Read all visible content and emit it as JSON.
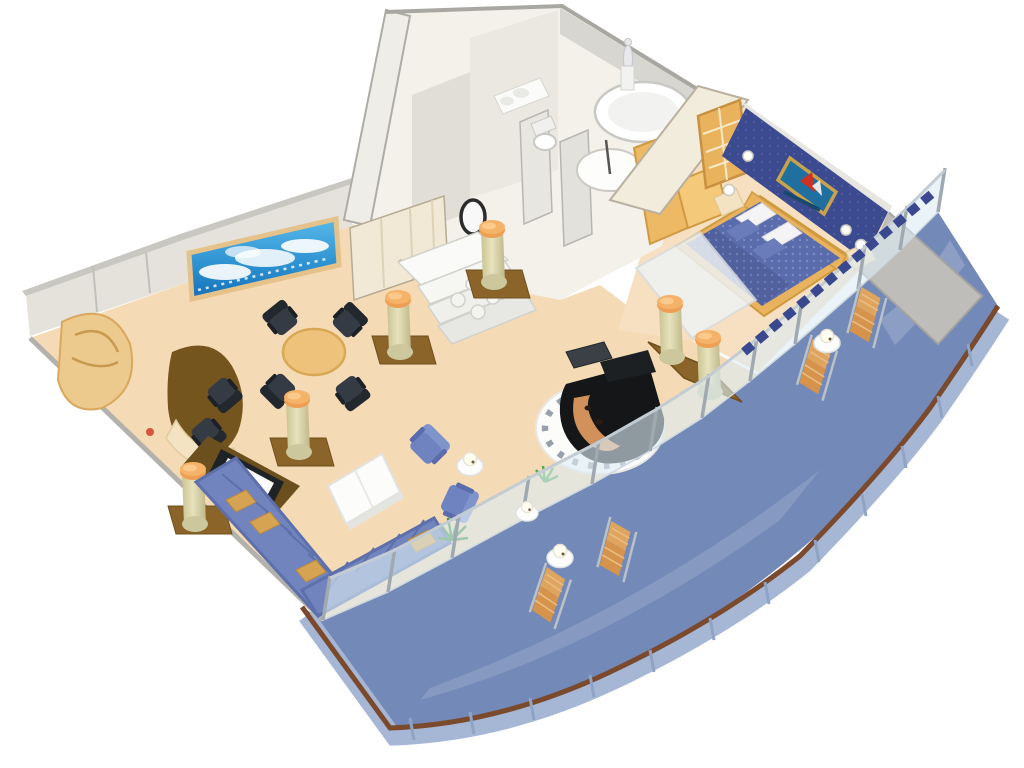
{
  "scene": {
    "type": "isometric-3d-floorplan-cutaway",
    "subject": "cruise-ship-owners-suite",
    "background": "#ffffff"
  },
  "palette": {
    "carpet": "#f5dab6",
    "carpet_light": "#f6e0c1",
    "deck_blue": "#7389b7",
    "deck_edge_band": "#a5b7d4",
    "handrail_brown": "#7b4a2d",
    "glass": "#dcebf3",
    "glass_post": "#9fa9af",
    "wall_light": "#eceae3",
    "wall_mid": "#dddbd3",
    "wall_cream": "#f1e9d6",
    "wall_top_edge": "#a9a7a1",
    "bedroom_wall_navy": "#3c4a90",
    "wood_light": "#f0c070",
    "wood_mid": "#e9b35d",
    "wood_dark": "#c89040",
    "desk_brown": "#74551d",
    "plinth_brown": "#8a6428",
    "column_body": "#ded9ae",
    "column_cap_orange": "#f2a858",
    "sofa_blue": "#7284bd",
    "sofa_shade": "#5d70ab",
    "cushion_tan": "#d6a353",
    "bed_blue": "#5b6cac",
    "pillow_white": "#f4f4f6",
    "pillow_blue": "#6b7cba",
    "chair_black": "#2d333a",
    "armchair_blue": "#6f83c0",
    "lounge_tan": "#dca05c",
    "piano_black": "#141618",
    "piano_soundboard": "#d2915a",
    "platform_white": "#fcfcfb",
    "platform_ring": "#98a0aa",
    "tv_black": "#1f2327",
    "tv_screen": "#fdfdfd",
    "plant_green": "#3f8f3d",
    "sky_top": "#57b8e8",
    "sky_deep": "#1470b8",
    "painting_sea": "#1f6f9f",
    "painting_sail_red": "#cc3322",
    "statue_white": "#e9e9ec",
    "tub_white": "#ffffff"
  },
  "rooms": {
    "living_room": {
      "name": "living-room",
      "furniture": [
        "sectional-sofa",
        "coffee-table",
        "armchair",
        "armchair",
        "side-table-lamp",
        "dining-table",
        "dining-chair-x4",
        "curved-desk",
        "desk-chair-x2",
        "corner-bar-cabinet",
        "tv-cabinet",
        "flat-tv",
        "grand-piano",
        "piano-platform",
        "piano-bench",
        "columns",
        "potted-plant",
        "panoramic-sea-window"
      ]
    },
    "bedroom": {
      "name": "bedroom",
      "furniture": [
        "double-bed",
        "headboard",
        "pillows",
        "nightstand-lamp-x2",
        "framed-sea-painting",
        "wardrobe",
        "french-doors",
        "curtain-zigzag-trim"
      ]
    },
    "bathroom": {
      "name": "bathroom",
      "furniture": [
        "round-jacuzzi-tub",
        "circular-shower",
        "toilet",
        "vanity-sinks",
        "statue",
        "round-mirror"
      ]
    },
    "entry": {
      "name": "entry-foyer",
      "furniture": [
        "marble-steps",
        "column-pair",
        "closet-doors"
      ]
    },
    "balcony": {
      "name": "private-balcony",
      "furniture": [
        "lounge-chair-x4",
        "round-table-lamp-x2",
        "glass-balustrade",
        "wood-handrail",
        "privacy-partition"
      ]
    }
  }
}
